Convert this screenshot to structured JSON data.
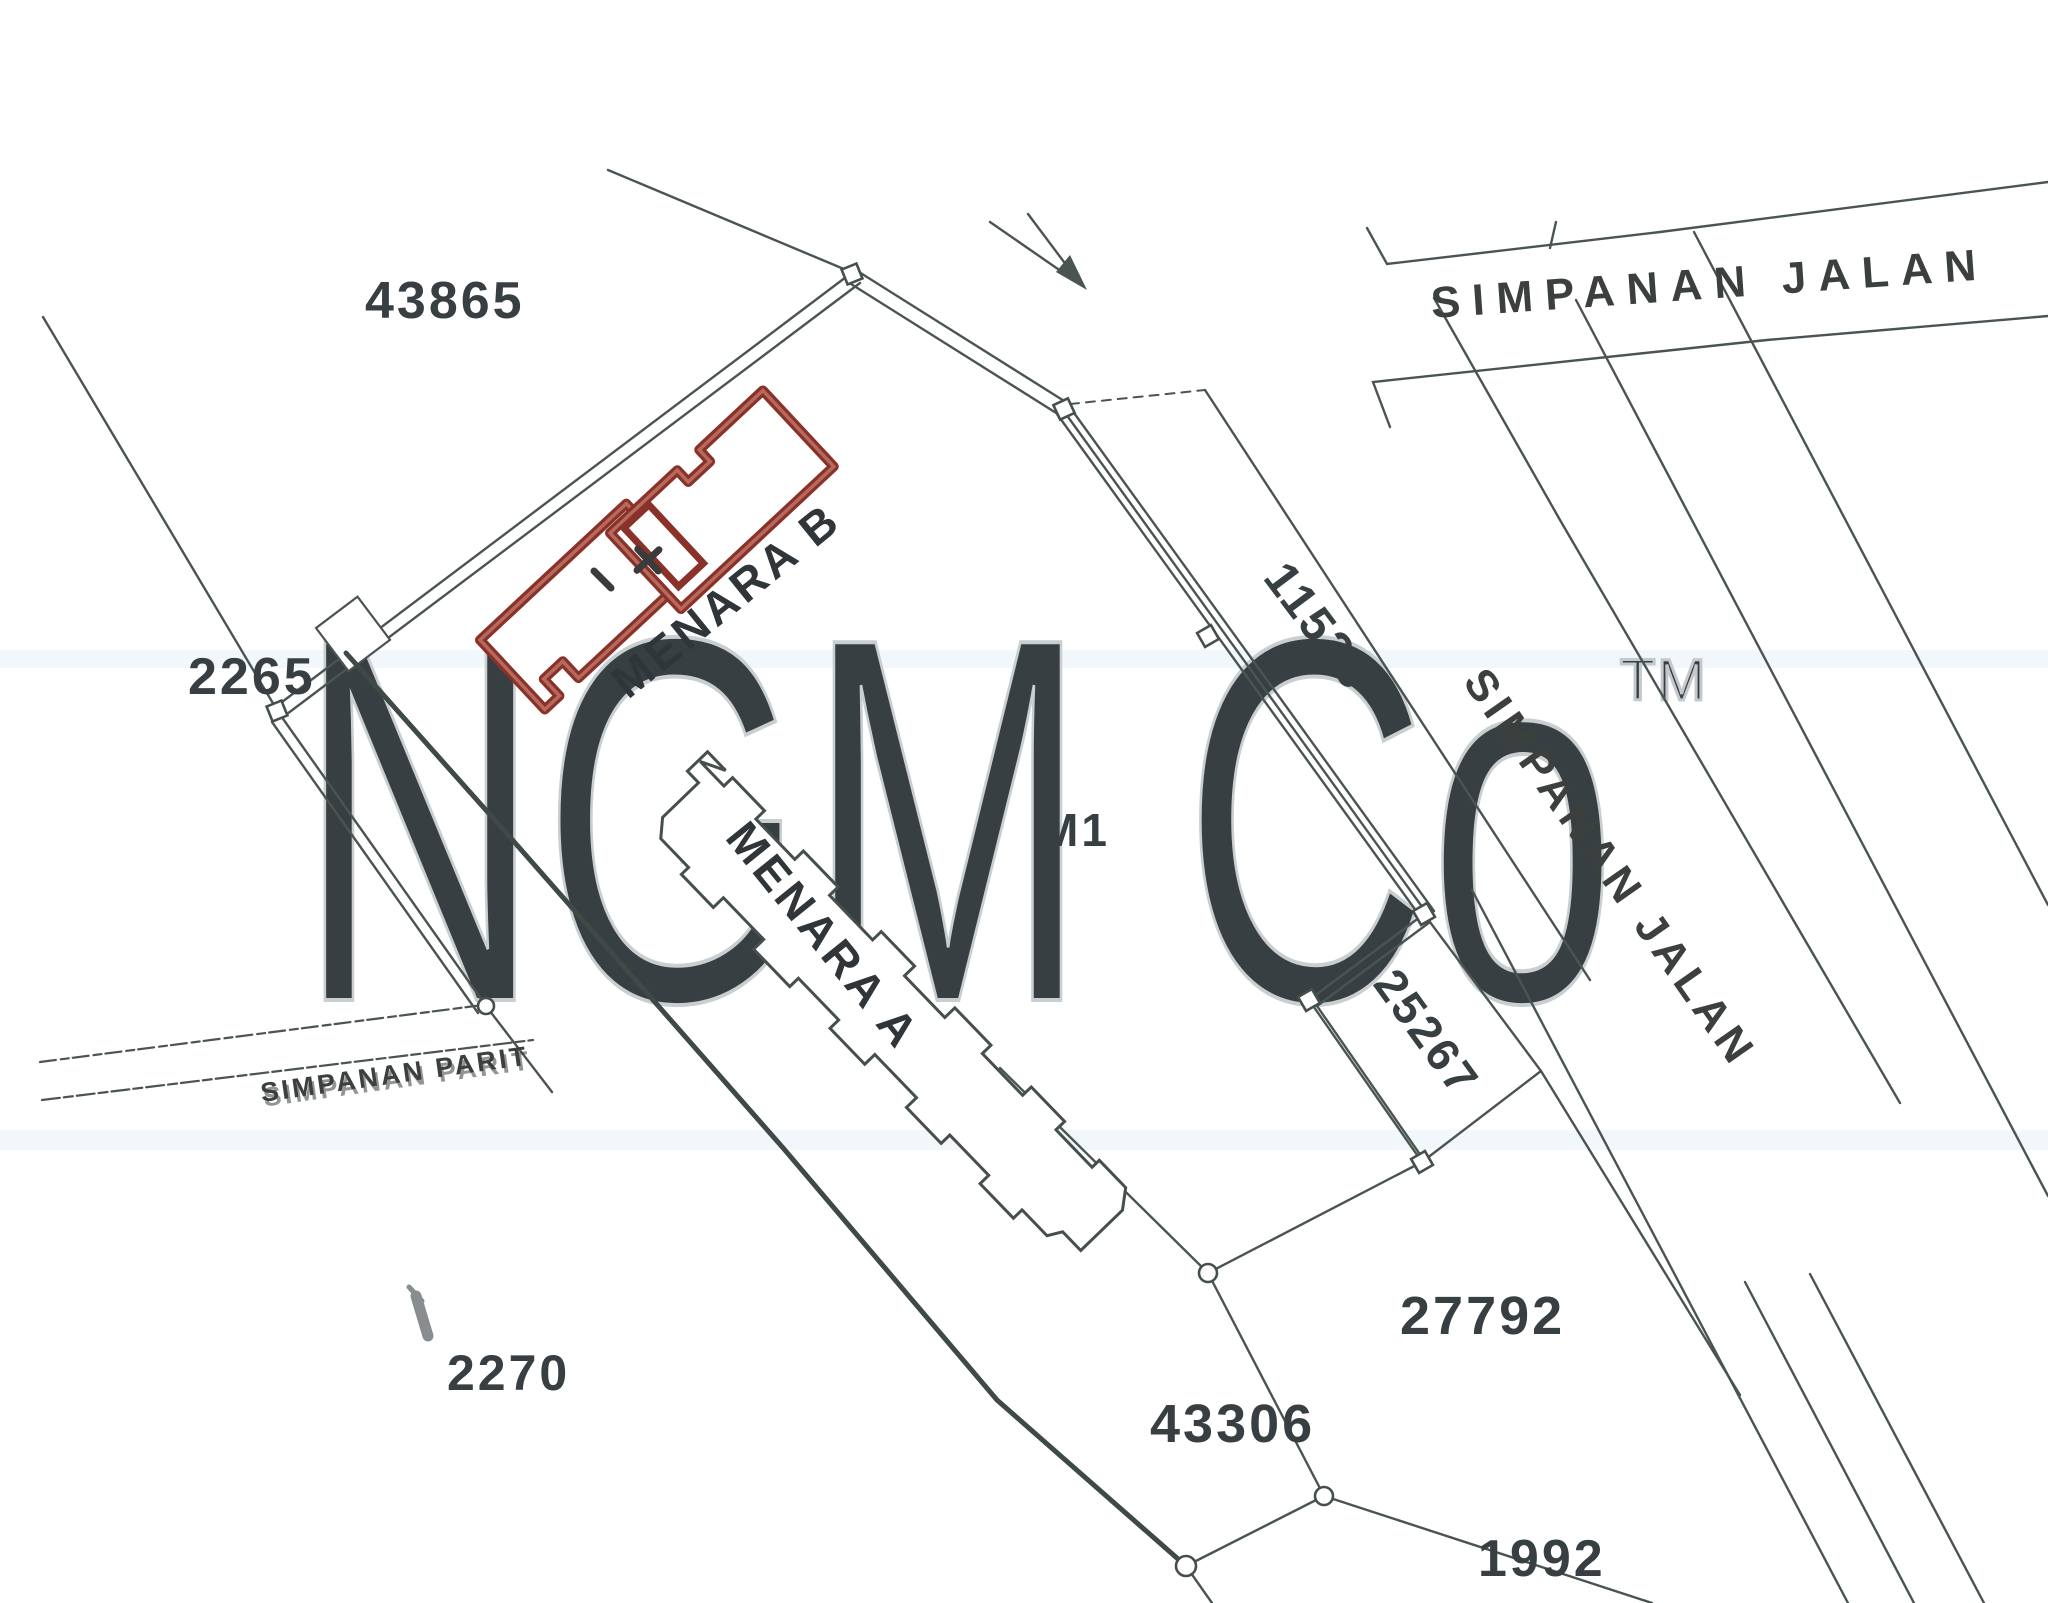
{
  "plan": {
    "title": "Cadastral site survey plan (scanned)",
    "watermark": {
      "text": "NGM Co",
      "tm": "TM",
      "color": "#c9ced1"
    },
    "lots": {
      "l43865": "43865",
      "l2265": "2265",
      "l2270": "2270",
      "l11526": "11526",
      "l25267": "25267",
      "l43306": "43306",
      "l27792": "27792",
      "l1992": "1992",
      "m1": "M1"
    },
    "buildings": {
      "menara_a": "MENARA A",
      "menara_b": "MENARA B"
    },
    "roads": {
      "jalan_top": "SIMPANAN JALAN",
      "jalan_diag": "SIMPANAN JALAN",
      "parit": "SIMPANAN PARIT"
    },
    "colors": {
      "ink": "#4a5450",
      "boundary_thick": "#3f4945",
      "highlight_building_outline": "#8a3129",
      "highlight_building_inner": "#b66a5e",
      "watermark": "#c9ced1",
      "paper": "#ffffff",
      "scan_tint_band": "#edf4f9"
    }
  }
}
